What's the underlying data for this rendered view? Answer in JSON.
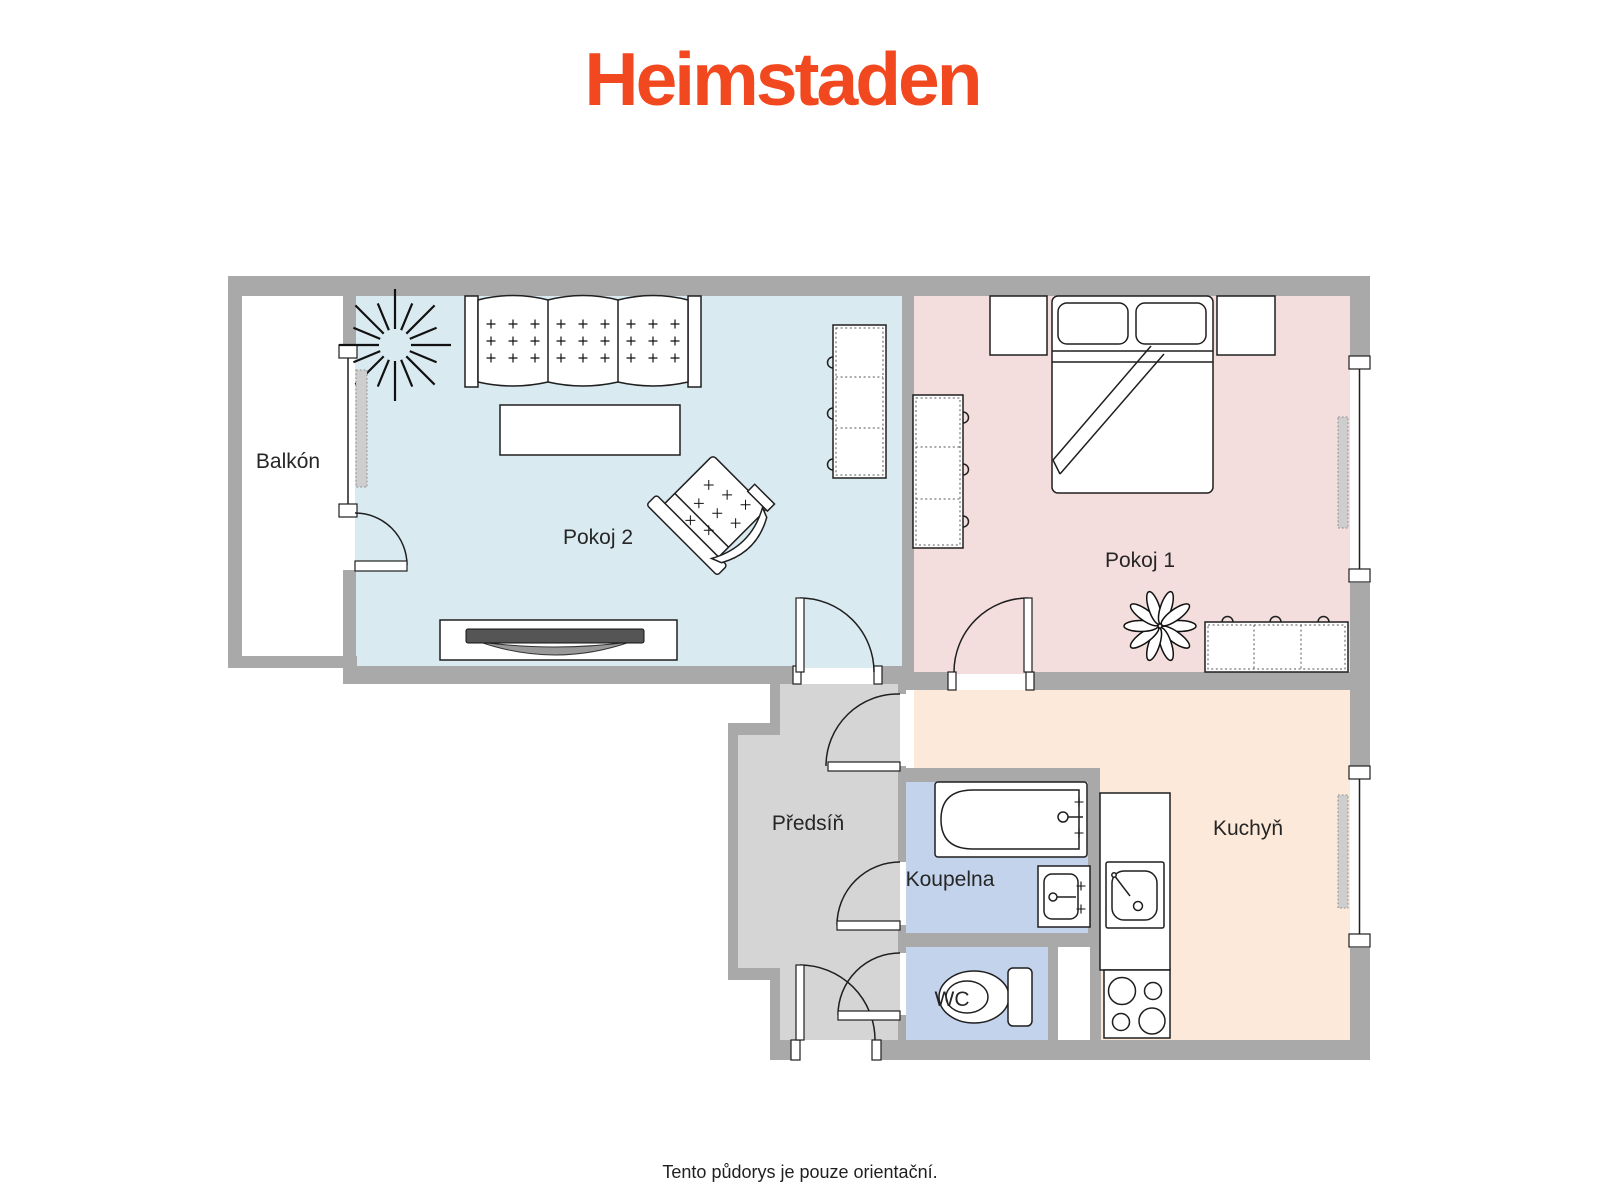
{
  "logo": {
    "text": "Heimstaden",
    "color": "#f2481f"
  },
  "plan": {
    "wall_color": "#a9a9a9",
    "outline_color": "#1f1f1f"
  },
  "rooms": {
    "balkon": {
      "label": "Balkón",
      "color": "#ffffff"
    },
    "pokoj2": {
      "label": "Pokoj 2",
      "color": "#daeaf1"
    },
    "pokoj1": {
      "label": "Pokoj 1",
      "color": "#f3dedd"
    },
    "predsin": {
      "label": "Předsíň",
      "color": "#d5d5d5"
    },
    "koupelna": {
      "label": "Koupelna",
      "color": "#c3d3ec"
    },
    "wc": {
      "label": "WC",
      "color": "#c3d3ec"
    },
    "kuchyn": {
      "label": "Kuchyň",
      "color": "#fce9d9"
    }
  },
  "footer": {
    "disclaimer": "Tento půdorys je pouze orientační."
  }
}
